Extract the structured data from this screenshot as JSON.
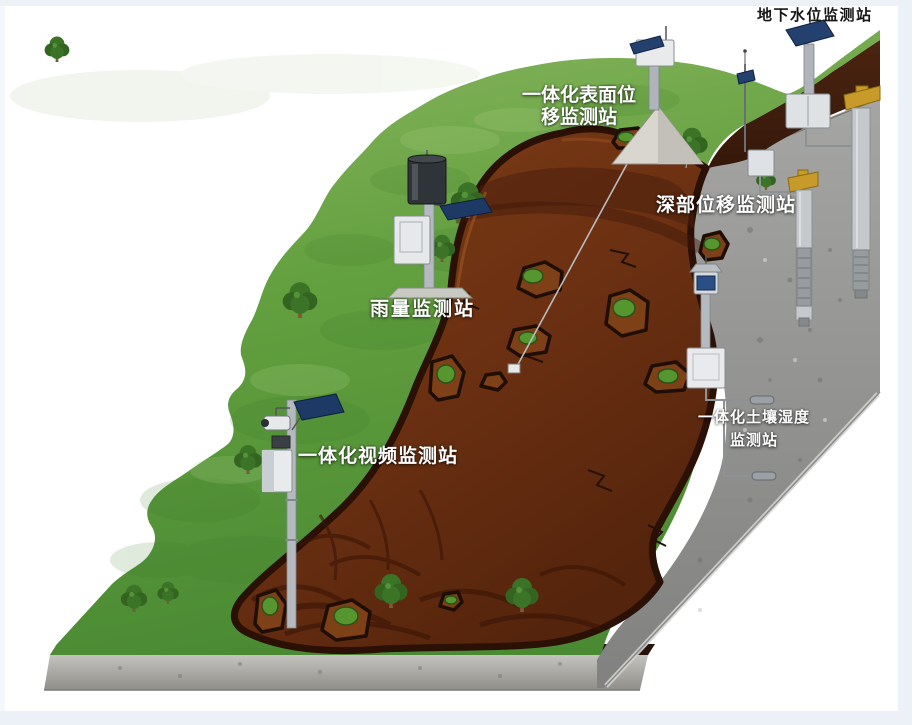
{
  "scene": {
    "title_hint": "landslide monitoring stations illustration",
    "labels": {
      "groundwater": {
        "text": "地下水位监测站"
      },
      "surface_displacement": {
        "text": "一体化表面位\n移监测站"
      },
      "deep_displacement": {
        "text": "深部位移监测站"
      },
      "rainfall": {
        "text": "雨量监测站"
      },
      "video": {
        "text": "一体化视频监测站"
      },
      "soil_moisture": {
        "text": "一体化土壤湿度\n监测站"
      }
    },
    "colors": {
      "grass": "#62a03e",
      "landslide": "#6b3012",
      "landslide_rim": "#2a1005",
      "rock": "#939391",
      "topsoil_band": "#3f1d0c",
      "solar_panel": "#23406e",
      "wellhead_gold": "#c79a2a",
      "label_white": "#ffffff",
      "label_black": "#161616",
      "frame": "#ecf1f8"
    }
  }
}
